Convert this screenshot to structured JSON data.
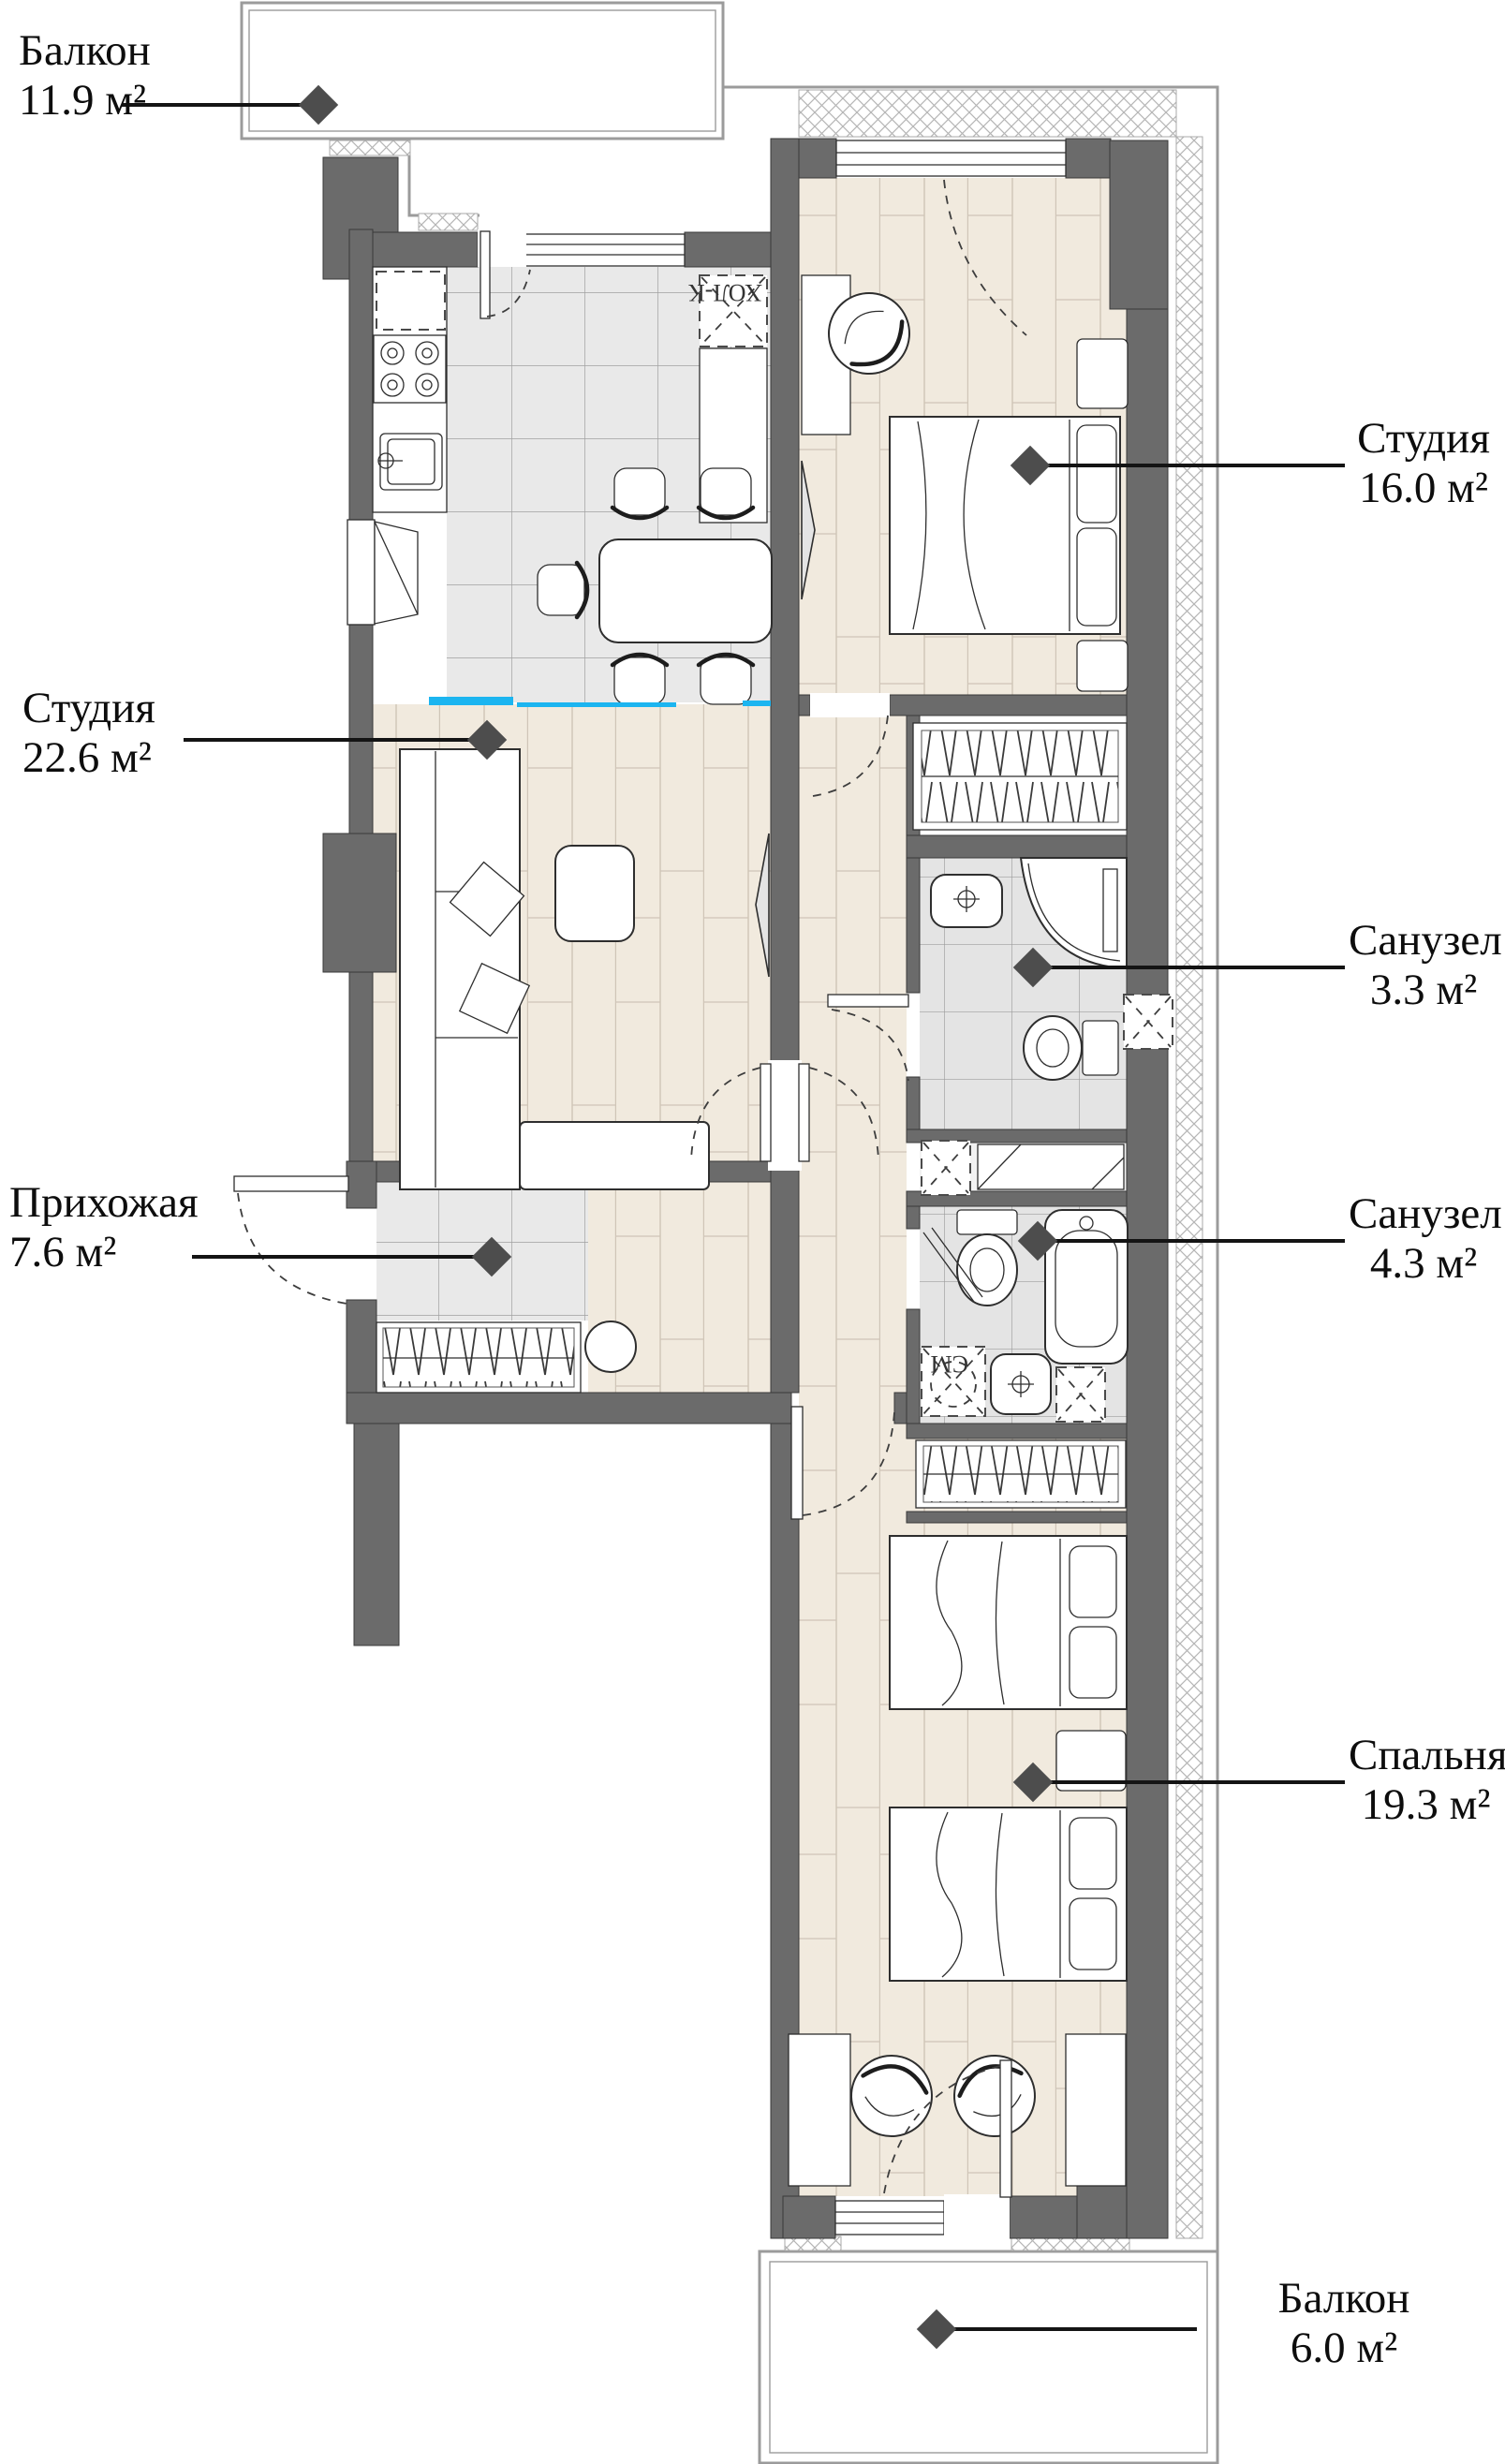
{
  "plan": {
    "type": "apartment-floor-plan",
    "labels": [
      {
        "id": "balcony-top",
        "name": "Балкон",
        "area": "11.9 м²"
      },
      {
        "id": "studio-22",
        "name": "Студия",
        "area": "22.6 м²"
      },
      {
        "id": "hallway",
        "name": "Прихожая",
        "area": "7.6 м²"
      },
      {
        "id": "studio-16",
        "name": "Студия",
        "area": "16.0 м²"
      },
      {
        "id": "bathroom-3",
        "name": "Санузел",
        "area": "3.3 м²"
      },
      {
        "id": "bathroom-4",
        "name": "Санузел",
        "area": "4.3 м²"
      },
      {
        "id": "bedroom",
        "name": "Спальня",
        "area": "19.3 м²"
      },
      {
        "id": "balcony-bottom",
        "name": "Балкон",
        "area": "6.0 м²"
      }
    ],
    "fixture_labels": {
      "fridge": "ХОЛ-К",
      "washer": "СМ"
    },
    "colors": {
      "wall": "#6b6b6b",
      "wood": "#f1eade",
      "tile": "#e9e9e9",
      "accent": "#1cb5f0"
    }
  }
}
